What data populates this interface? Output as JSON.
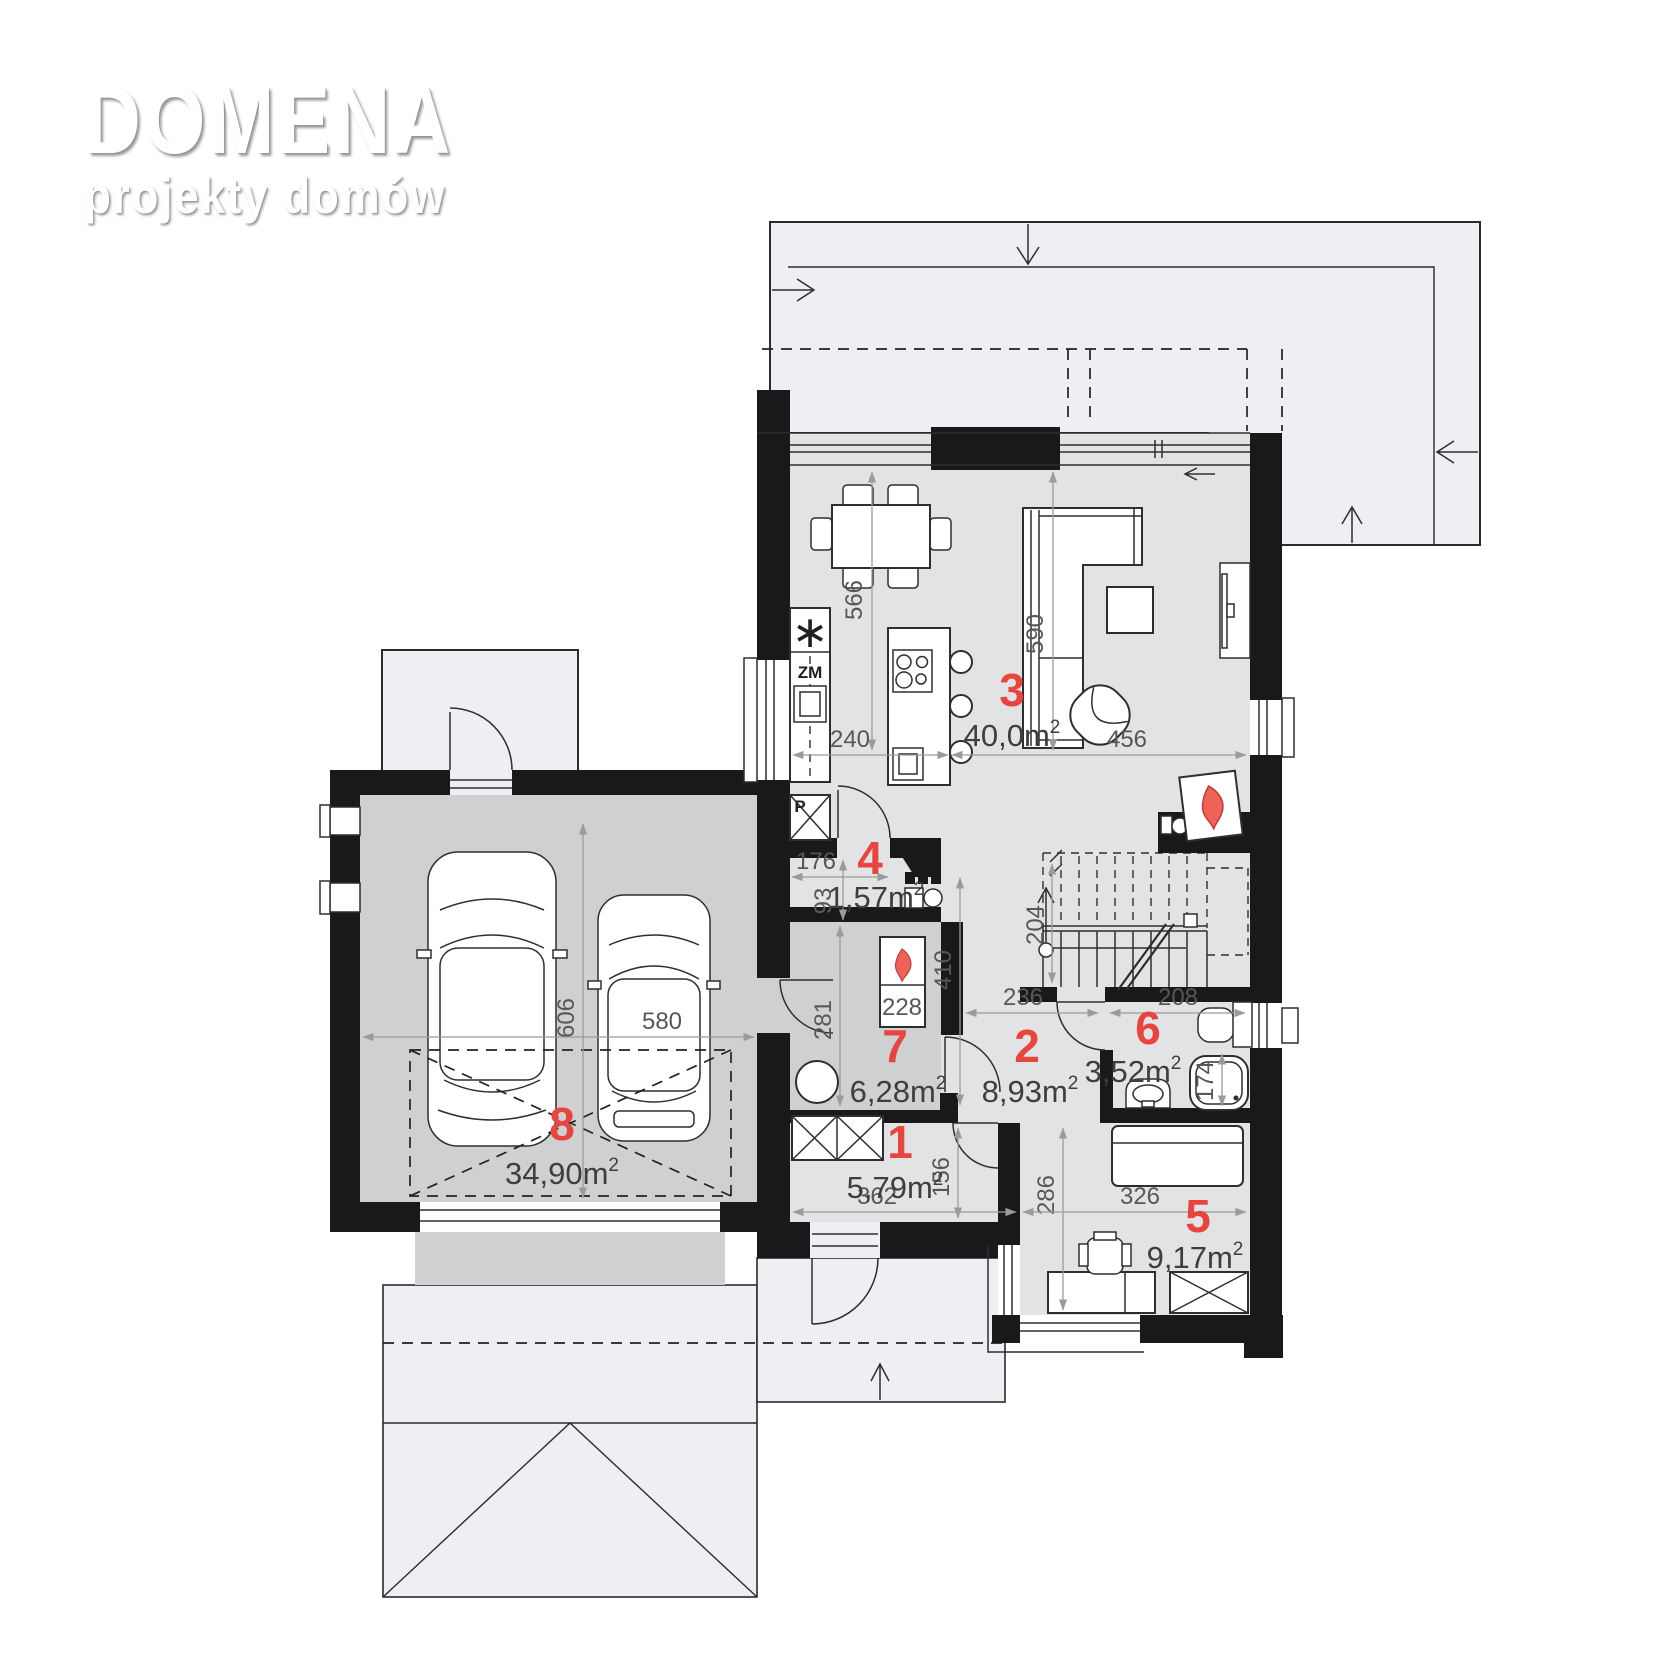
{
  "logo": {
    "title": "DOMENA",
    "subtitle": "projekty domów"
  },
  "plan_title": "rzut parteru",
  "rooms": [
    {
      "n": "1",
      "area": "5,79m"
    },
    {
      "n": "2",
      "area": "8,93m"
    },
    {
      "n": "3",
      "area": "40,0m"
    },
    {
      "n": "4",
      "area": "1,57m"
    },
    {
      "n": "5",
      "area": "9,17m"
    },
    {
      "n": "6",
      "area": "3,52m"
    },
    {
      "n": "7",
      "area": "6,28m"
    },
    {
      "n": "8",
      "area": "34,90m"
    }
  ],
  "sup": "2",
  "dims": {
    "d566": "566",
    "d590": "590",
    "d240": "240",
    "d456": "456",
    "d176": "176",
    "d93": "93",
    "d410": "410",
    "d204": "204",
    "d236": "236",
    "d208": "208",
    "d174": "174",
    "d281": "281",
    "d286": "286",
    "d326": "326",
    "d606": "606",
    "d580": "580",
    "d362": "362",
    "d156": "156"
  },
  "equipment": {
    "fridge": "∗",
    "dishwasher": "ZM",
    "oven": "P",
    "boiler": "228"
  },
  "colors": {
    "accent_red": "#e8453f",
    "wall": "#19191b",
    "floor": "#e2e3e5",
    "floor_dark": "#cfd0d2",
    "exterior": "#edeff3"
  }
}
